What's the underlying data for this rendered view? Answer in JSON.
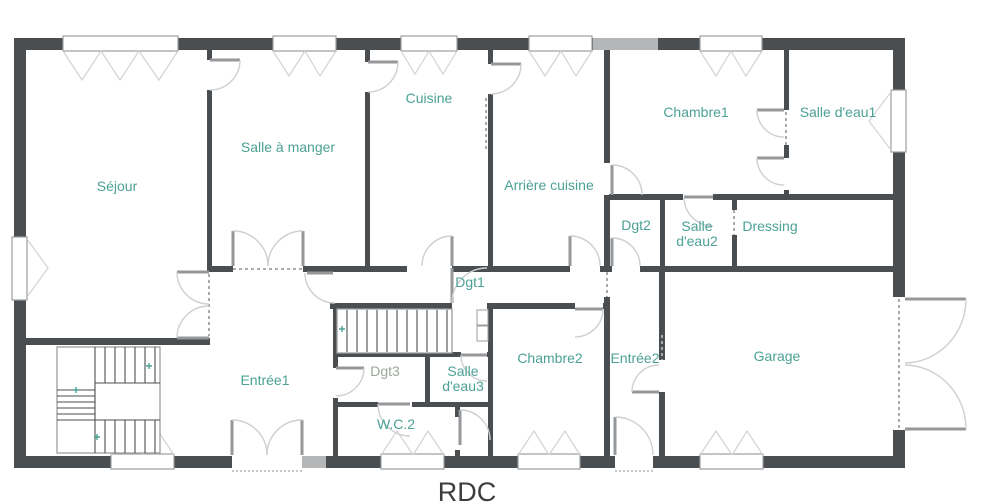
{
  "floor_plan": {
    "title": "RDC",
    "labels": {
      "sejour": "Séjour",
      "salle_a_manger": "Salle à manger",
      "cuisine": "Cuisine",
      "arriere_cuisine": "Arrière cuisine",
      "chambre1": "Chambre1",
      "salle_deau1": "Salle d'eau1",
      "dgt2": "Dgt2",
      "salle_deau2_l1": "Salle",
      "salle_deau2_l2": "d'eau2",
      "dressing": "Dressing",
      "dgt1": "Dgt1",
      "entree1": "Entrée1",
      "dgt3": "Dgt3",
      "salle_deau3_l1": "Salle",
      "salle_deau3_l2": "d'eau3",
      "wc2": "W.C.2",
      "chambre2": "Chambre2",
      "entree2": "Entrée2",
      "garage": "Garage"
    },
    "colors": {
      "wall": "#4b4e51",
      "wall_light": "#b4b6b8",
      "room_label": "#4ba195",
      "room_label_muted": "#9aa79b",
      "door_arc": "#cdcfd1",
      "window_frame": "#9b9da0",
      "title_text": "#3d3d3d"
    }
  }
}
